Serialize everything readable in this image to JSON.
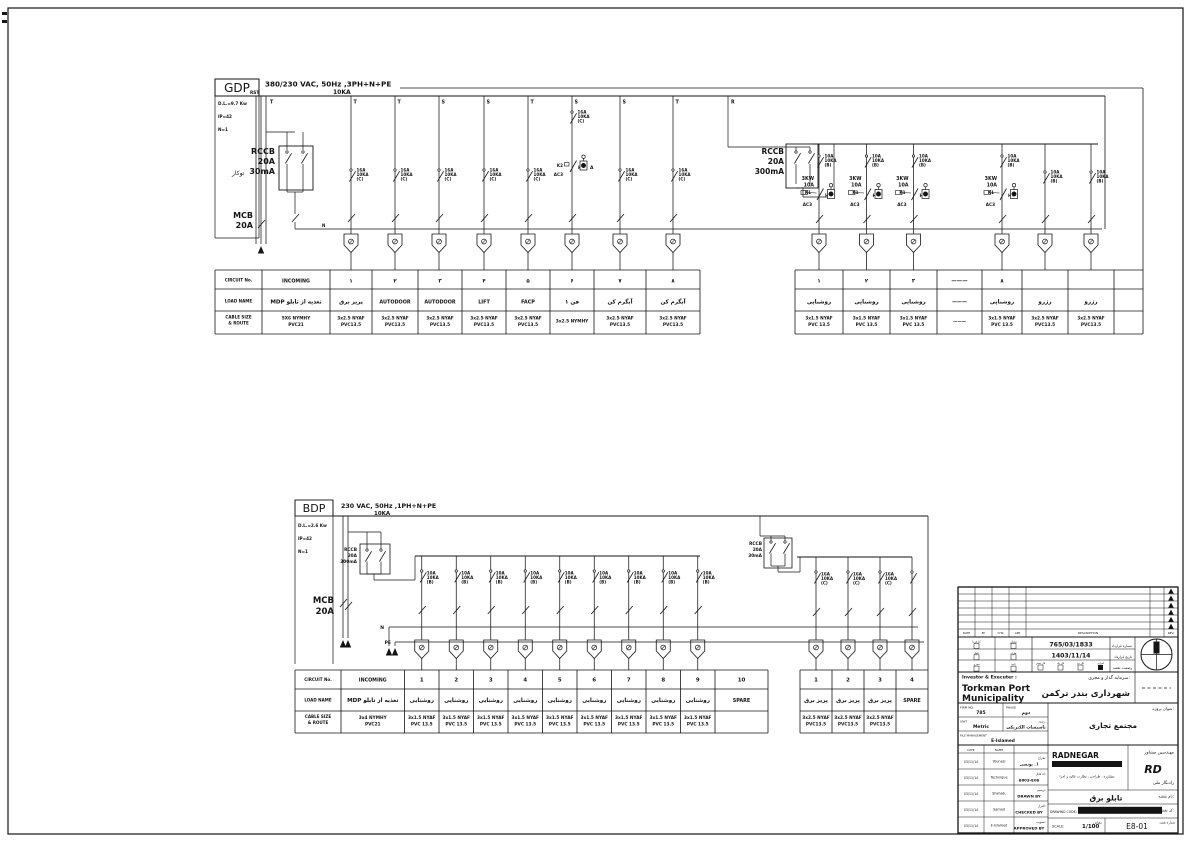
{
  "table_headers": [
    "CIRCUIT  No.",
    "LOAD  NAME",
    "CABLE  SIZE",
    "&  ROUTE"
  ],
  "gdp": {
    "title": "GDP",
    "voltage": "380/230  VAC,  50Hz  ,3PH+N+PE",
    "breaking": "10KA",
    "specs": [
      "D.L.=9.7 Kw",
      "IP=42",
      "N=1"
    ],
    "mount": "توکار",
    "incoming_phases": "RST",
    "incoming_t": "T",
    "rccb_main": [
      "RCCB",
      "20A",
      "30mA"
    ],
    "mcb_main": [
      "MCB",
      "20A"
    ],
    "rccb_light": [
      "RCCB",
      "20A",
      "300mA"
    ],
    "n": "N",
    "phase_labels": [
      "T",
      "T",
      "S",
      "S",
      "T",
      "S",
      "S",
      "T"
    ],
    "feeder_phase": "R",
    "mcb_c": [
      "16A",
      "10KA",
      "(C)"
    ],
    "mcb_b": [
      "10A",
      "10KA",
      "(B)"
    ],
    "cont_power": [
      "3KW",
      "10A"
    ],
    "k1": "K1",
    "k2": "K2",
    "ac3": "AC3",
    "lamp": "H",
    "amp": "A",
    "table": {
      "cols": [
        {
          "no": "INCOMING",
          "load": "MDP تغذیه از تابلو",
          "cable": [
            "5X6  NYMHY",
            "PVC21"
          ]
        },
        {
          "no": "۱",
          "load": "پریز برق",
          "cable": [
            "3x2.5  NYAF",
            "PVC13.5"
          ]
        },
        {
          "no": "۲",
          "load": "AUTODOOR",
          "cable": [
            "3x2.5  NYAF",
            "PVC13.5"
          ]
        },
        {
          "no": "۳",
          "load": "AUTODOOR",
          "cable": [
            "3x2.5  NYAF",
            "PVC13.5"
          ]
        },
        {
          "no": "۴",
          "load": "LIFT",
          "cable": [
            "3x2.5  NYAF",
            "PVC13.5"
          ]
        },
        {
          "no": "۵",
          "load": "FACP",
          "cable": [
            "3x2.5  NYAF",
            "PVC13.5"
          ]
        },
        {
          "no": "۶",
          "load": "فن ۱",
          "cable": [
            "3x2.5  NYMHY"
          ]
        },
        {
          "no": "۷",
          "load": "آبگرم کن",
          "cable": [
            "3x2.5  NYAF",
            "PVC13.5"
          ]
        },
        {
          "no": "۸",
          "load": "آبگرم کن",
          "cable": [
            "3x2.5  NYAF",
            "PVC13.5"
          ]
        },
        {
          "no": "۱",
          "load": "روشنایی",
          "cable": [
            "3x1.5  NYAF",
            "PVC 13.5"
          ]
        },
        {
          "no": "۲",
          "load": "روشنایی",
          "cable": [
            "3x1.5  NYAF",
            "PVC 13.5"
          ]
        },
        {
          "no": "۳",
          "load": "روشنایی",
          "cable": [
            "3x1.5  NYAF",
            "PVC 13.5"
          ]
        },
        {
          "no": "———",
          "load": "———",
          "cable": [
            "———"
          ]
        },
        {
          "no": "۸",
          "load": "روشنایی",
          "cable": [
            "3x1.5  NYAF",
            "PVC 13.5"
          ]
        },
        {
          "no": "",
          "load": "رزرو",
          "cable": [
            "3x2.5  NYAF",
            "PVC13.5"
          ]
        },
        {
          "no": "",
          "load": "رزرو",
          "cable": [
            "3x2.5  NYAF",
            "PVC13.5"
          ]
        },
        {
          "no": "",
          "load": "",
          "cable": []
        }
      ]
    }
  },
  "bdp": {
    "title": "BDP",
    "voltage": "230  VAC,  50Hz  ,1PH+N+PE",
    "breaking": "10KA",
    "specs": [
      "D.L.=2.6 Kw",
      "IP=42",
      "N=1"
    ],
    "rccb_main": [
      "RCCB",
      "20A",
      "300mA"
    ],
    "rccb_socket": [
      "RCCB",
      "20A",
      "30mA"
    ],
    "mcb_main": [
      "MCB",
      "20A"
    ],
    "n": "N",
    "pe": "PE",
    "mcb_b": [
      "10A",
      "10KA",
      "(B)"
    ],
    "mcb_c": [
      "16A",
      "10KA",
      "(C)"
    ],
    "table": {
      "cols": [
        {
          "no": "INCOMING",
          "load": "MDP تغذیه از تابلو",
          "cable": [
            "3x4  NYMHY",
            "PVC21"
          ]
        },
        {
          "no": "1",
          "load": "روشنایی",
          "cable": [
            "3x1.5  NYAF",
            "PVC 13.5"
          ]
        },
        {
          "no": "2",
          "load": "روشنایی",
          "cable": [
            "3x1.5  NYAF",
            "PVC 13.5"
          ]
        },
        {
          "no": "3",
          "load": "روشنایی",
          "cable": [
            "3x1.5  NYAF",
            "PVC 13.5"
          ]
        },
        {
          "no": "4",
          "load": "روشنایی",
          "cable": [
            "3x1.5  NYAF",
            "PVC 13.5"
          ]
        },
        {
          "no": "5",
          "load": "روشنایی",
          "cable": [
            "3x1.5  NYAF",
            "PVC 13.5"
          ]
        },
        {
          "no": "6",
          "load": "روشنایی",
          "cable": [
            "3x1.5  NYAF",
            "PVC 13.5"
          ]
        },
        {
          "no": "7",
          "load": "روشنایی",
          "cable": [
            "3x1.5  NYAF",
            "PVC 13.5"
          ]
        },
        {
          "no": "8",
          "load": "روشنایی",
          "cable": [
            "3x1.5  NYAF",
            "PVC 13.5"
          ]
        },
        {
          "no": "9",
          "load": "روشنایی",
          "cable": [
            "3x1.5  NYAF",
            "PVC 13.5"
          ]
        },
        {
          "no": "10",
          "load": "SPARE",
          "cable": []
        },
        {
          "no": "1",
          "load": "پریز برق",
          "cable": [
            "3x2.5  NYAF",
            "PVC13.5"
          ]
        },
        {
          "no": "2",
          "load": "پریز برق",
          "cable": [
            "3x2.5  NYAF",
            "PVC13.5"
          ]
        },
        {
          "no": "3",
          "load": "پریز برق",
          "cable": [
            "3x2.5  NYAF",
            "PVC13.5"
          ]
        },
        {
          "no": "4",
          "load": "SPARE",
          "cable": []
        }
      ]
    }
  },
  "tb": {
    "rev": {
      "cols": [
        "DATE",
        "BY",
        "CHK",
        "APP"
      ],
      "desc": "DESCRIPTION",
      "rev": "REV."
    },
    "approvals": [
      "کارفرما",
      "مشاور",
      "ناظر",
      "طراح",
      "مجری",
      "تایید"
    ],
    "contract_no": "765/03/1833",
    "contract_no_label": "شماره قرارداد",
    "contract_date": "1403/11/14",
    "contract_date_label": "تاریخ قرارداد",
    "stages": [
      "فاز صفر",
      "فاز یک",
      "فاز دو",
      "اجرایی"
    ],
    "status_label": "وضعیت نقشه",
    "investor_label_en": "Investor  &  Executer  :",
    "investor_label_fa": "سرمایه گذار و مجری:",
    "investor_en1": "Torkman  Port",
    "investor_en2": "Municipality",
    "investor_fa": "شهرداری بندر ترکمن",
    "firm_label": "FIRM NO.",
    "firm": "785",
    "phase_label": "PHASE",
    "phase": "دوم",
    "unit_label": "UNIT",
    "unit": "Metric",
    "discipline_label": "رشته:",
    "discipline": "تاسیسات الکتریکی",
    "filemgmt_label": "FILE MANAGEMENT",
    "filemgmt": "E-Islamed",
    "project_label": "عنوان پروژه:",
    "project": "مجتمع تجاری",
    "sign_headers": [
      "DATE",
      "NAME"
    ],
    "signs": [
      {
        "date": "03/11/14",
        "name": "Younesi",
        "label": "طراح:",
        "value": "ا . یونسی"
      },
      {
        "date": "03/11/14",
        "name": "Technique",
        "label": "کد فایل:",
        "value": "8603-E08"
      },
      {
        "date": "03/11/14",
        "name": "Shahab.",
        "label": "ترسیم:",
        "value": "DRAWN BY"
      },
      {
        "date": "03/11/14",
        "name": "Samad",
        "label": "کنترل:",
        "value": "CHECKED BY"
      },
      {
        "date": "03/11/14",
        "name": "E-Islamed",
        "label": "تصویب:",
        "value": "APPROVED BY"
      }
    ],
    "consultant_en": "RADNEGAR",
    "consultant_bar": "CONSULTING  ENGINEERS  CO.",
    "consultant_tagline": "مشاوره ، طراحی ، نظارت عالیه و اجرا",
    "consultant_fa1": "مهندسین مشاور",
    "consultant_fa2": "رادنگار ملی",
    "consultant_logo": "RD",
    "dwg_name_label": "نام نقشه:",
    "dwg_name": "تابلو برق",
    "dwg_code_label": "کد نقشه:",
    "dwg_code_en": "DRAWING  CODE:",
    "dwg_code": "GN/TKM/CM/EX/DESIGN/PH/E8/03",
    "scale_label": "SCALE:",
    "scale": "1/100",
    "scale_fa": "مقیاس",
    "sheet_no": "E8-01",
    "sheet_no_label": "شماره نقشه"
  }
}
